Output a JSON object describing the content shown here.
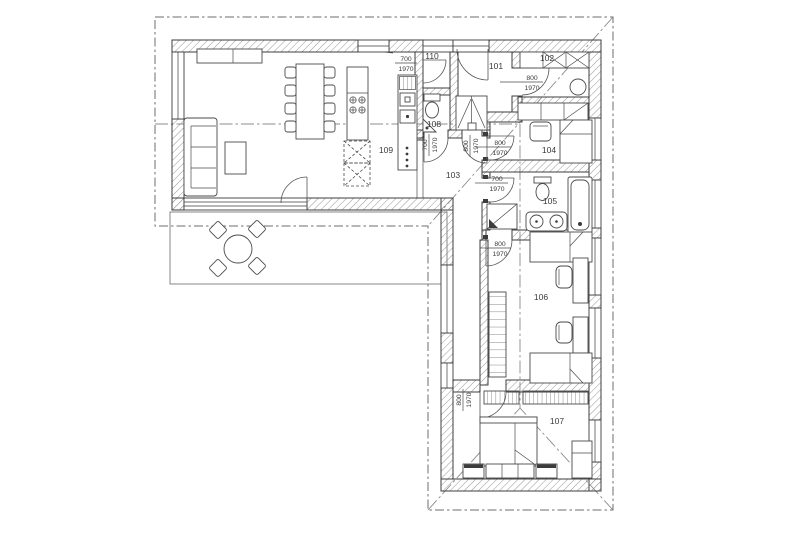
{
  "plan_title": "floor-plan",
  "colors": {
    "line": "#3c3c3c",
    "hatch": "#8a8a8a",
    "roof_dash": "#6e6e6e",
    "background": "#ffffff"
  },
  "rooms": [
    {
      "label": "101"
    },
    {
      "label": "102"
    },
    {
      "label": "103"
    },
    {
      "label": "104"
    },
    {
      "label": "105"
    },
    {
      "label": "106"
    },
    {
      "label": "107"
    },
    {
      "label": "108"
    },
    {
      "label": "109"
    },
    {
      "label": "110"
    }
  ],
  "door_tags": [
    {
      "width": "700",
      "height": "1970"
    },
    {
      "width": "800",
      "height": "1970"
    },
    {
      "width": "800",
      "height": "1970"
    },
    {
      "width": "700",
      "height": "1970"
    },
    {
      "width": "700",
      "height": "1970"
    },
    {
      "width": "800",
      "height": "1970"
    },
    {
      "width": "800",
      "height": "1970"
    },
    {
      "width": "800",
      "height": "1970"
    }
  ]
}
